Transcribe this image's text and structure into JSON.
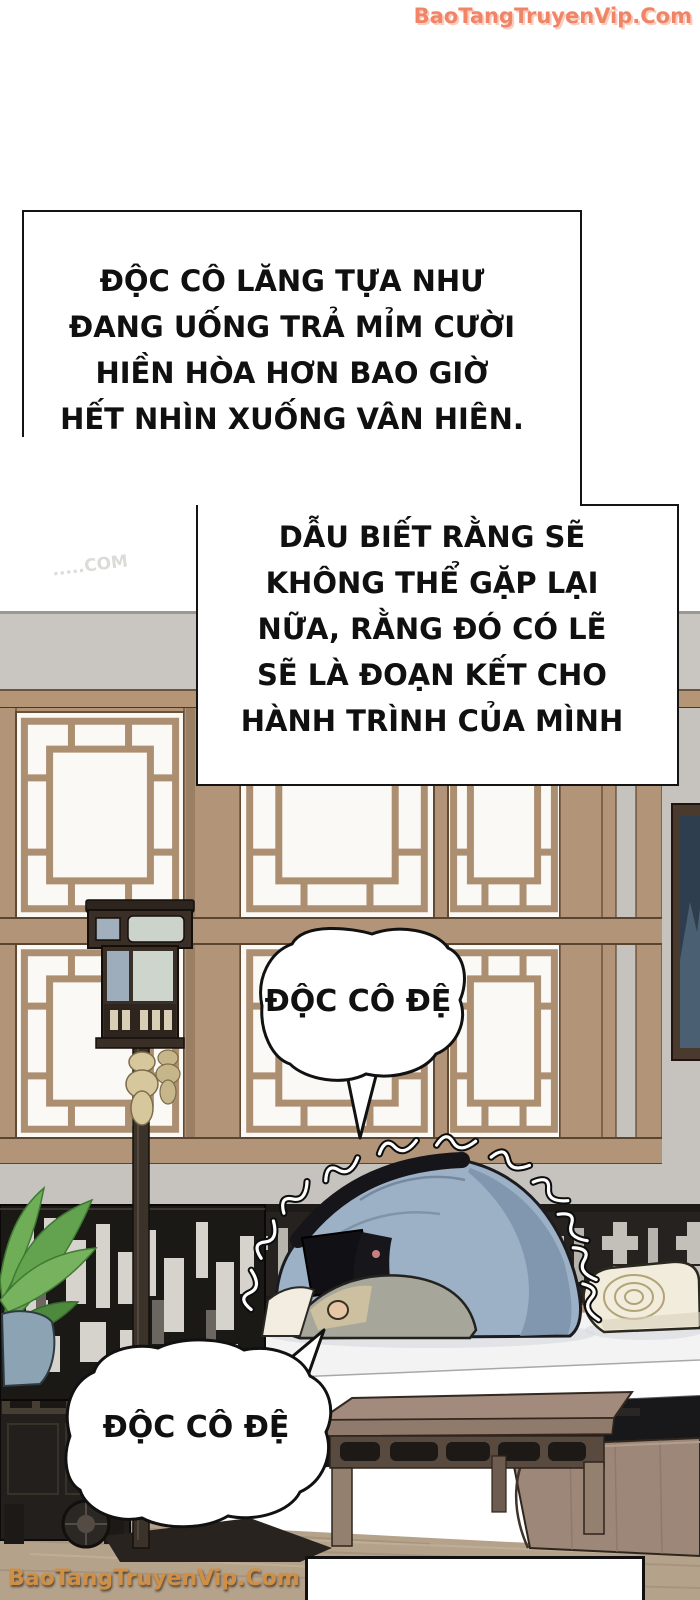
{
  "watermarks": {
    "top": "BaoTangTruyenVip.Com",
    "bottom": "BaoTangTruyenVip.Com",
    "faint": ".....COM"
  },
  "narration_box_1": {
    "lines": [
      "ĐỘC CÔ LĂNG TỰA NHƯ",
      "ĐANG UỐNG TRẢ MỈM CƯỜI",
      "HIỀN HÒA HƠN BAO GIỜ",
      "HẾT NHÌN XUỐNG VÂN HIÊN."
    ]
  },
  "narration_box_2": {
    "lines": [
      "DẪU BIẾT RẰNG SẼ",
      "KHÔNG THỂ GẶP LẠI",
      "NỮA, RẰNG ĐÓ CÓ LẼ",
      "SẼ LÀ ĐOẠN KẾT CHO",
      "HÀNH TRÌNH CỦA MÌNH"
    ]
  },
  "speech_bubble_1": {
    "text": "ĐỘC CÔ ĐỆ"
  },
  "speech_bubble_2": {
    "text": "ĐỘC CÔ ĐỆ"
  },
  "colors": {
    "panel_border": "#141414",
    "watermark_top": "#ef8566",
    "watermark_bottom": "#cf9046",
    "wood_tan": "#b29478",
    "wall_gray": "#c6c3be",
    "robe_blue": "#9cb1c6",
    "floor_tan": "#b5a28b",
    "dark_wood": "#23201d"
  }
}
